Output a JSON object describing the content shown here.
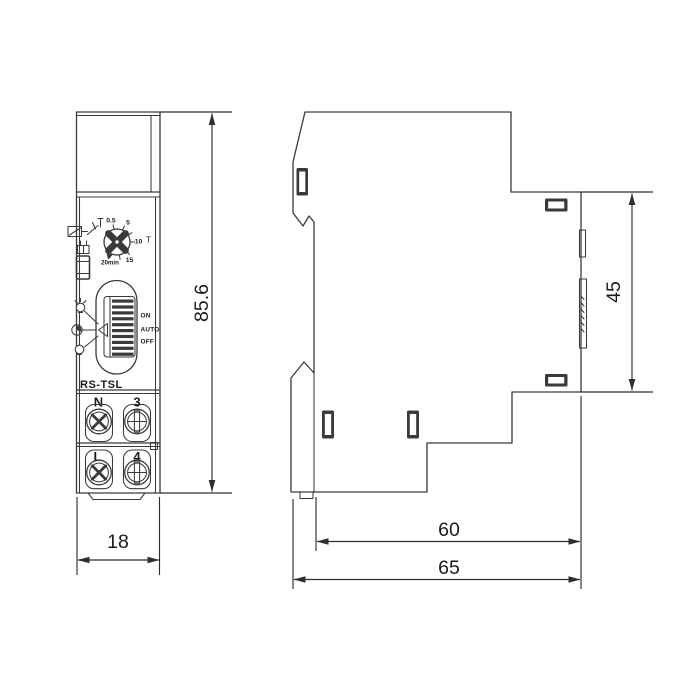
{
  "front_view": {
    "model": "RS-TSL",
    "dial": {
      "d05": "0.5",
      "d5": "5",
      "d10": "10",
      "d15": "15",
      "d20min": "20min",
      "unit": "T"
    },
    "switch": {
      "on": "ON",
      "auto": "AUTO",
      "off": "OFF"
    },
    "terminals": {
      "neutral": "N",
      "no3": "3",
      "line": "L",
      "no4": "4"
    }
  },
  "dimensions": {
    "height": "85.6",
    "width": "18",
    "front_depth": "45",
    "body_depth": "60",
    "total_depth": "65"
  },
  "colors": {
    "line": "#3a3a3a",
    "text": "#1b1b1b",
    "slot_fill": "#3a3a3a",
    "background": "#ffffff"
  }
}
